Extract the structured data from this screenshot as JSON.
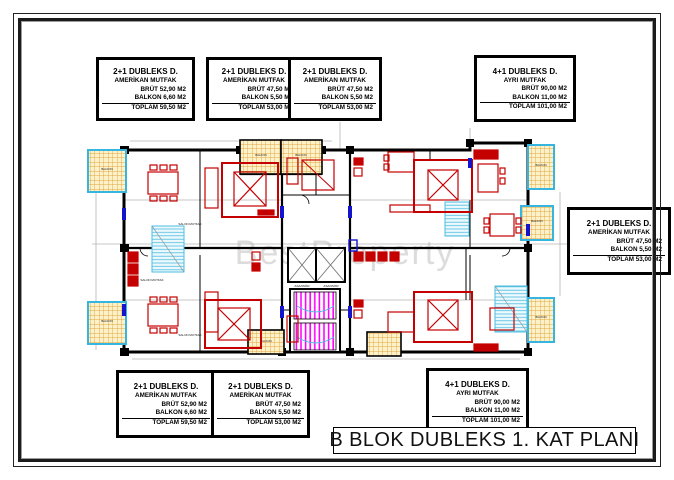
{
  "page": {
    "title": "B BLOK DUBLEKS 1. KAT PLANI",
    "watermark": "BestProperty"
  },
  "colors": {
    "wall_black": "#000000",
    "furniture_red": "#c40000",
    "balcony_cyan": "#35b5e0",
    "balcony_fill_yellow": "#fcf1c9",
    "hatch_orange": "#dfa640",
    "stair_magenta": "#ff00ff",
    "door_blue": "#1414cc",
    "dimension_gray": "#b4b4b4",
    "watermark_gray": "#dcdcdc"
  },
  "plan_labels": {
    "asansor": "ASANSÖR",
    "salon_mutfak": "SALON MUTFAK",
    "balkon": "BALKON"
  },
  "unit_boxes": [
    {
      "id": "top-left",
      "lines": [
        "2+1 DUBLEKS D.",
        "AMERİKAN MUTFAK",
        "BRÜT 52,90 M2",
        "BALKON  6,60 M2",
        "TOPLAM 59,50 M2"
      ]
    },
    {
      "id": "top-mid-left",
      "lines": [
        "2+1 DUBLEKS D.",
        "AMERİKAN MUTFAK",
        "BRÜT 47,50 M2",
        "BALKON  5,50 M2",
        "TOPLAM 53,00 M2"
      ]
    },
    {
      "id": "top-mid-right",
      "lines": [
        "2+1 DUBLEKS D.",
        "AMERİKAN MUTFAK",
        "BRÜT 47,50 M2",
        "BALKON  5,50 M2",
        "TOPLAM 53,00 M2"
      ]
    },
    {
      "id": "top-right",
      "lines": [
        "4+1 DUBLEKS D.",
        "AYRI MUTFAK",
        "BRÜT 90,00 M2",
        "BALKON 11,00 M2",
        "TOPLAM 101,00 M2"
      ]
    },
    {
      "id": "right",
      "lines": [
        "2+1 DUBLEKS D.",
        "AMERİKAN MUTFAK",
        "BRÜT 47,50 M2",
        "BALKON  5,50 M2",
        "TOPLAM 53,00 M2"
      ]
    },
    {
      "id": "bottom-left",
      "lines": [
        "2+1 DUBLEKS D.",
        "AMERİKAN MUTFAK",
        "BRÜT 52,90 M2",
        "BALKON  6,60 M2",
        "TOPLAM 59,50 M2"
      ]
    },
    {
      "id": "bottom-mid",
      "lines": [
        "2+1 DUBLEKS D.",
        "AMERİKAN MUTFAK",
        "BRÜT 47,50 M2",
        "BALKON  5,50 M2",
        "TOPLAM 53,00 M2"
      ]
    },
    {
      "id": "bottom-right",
      "lines": [
        "4+1 DUBLEKS D.",
        "AYRI MUTFAK",
        "BRÜT 90,00 M2",
        "BALKON 11,00 M2",
        "TOPLAM 101,00 M2"
      ]
    }
  ]
}
